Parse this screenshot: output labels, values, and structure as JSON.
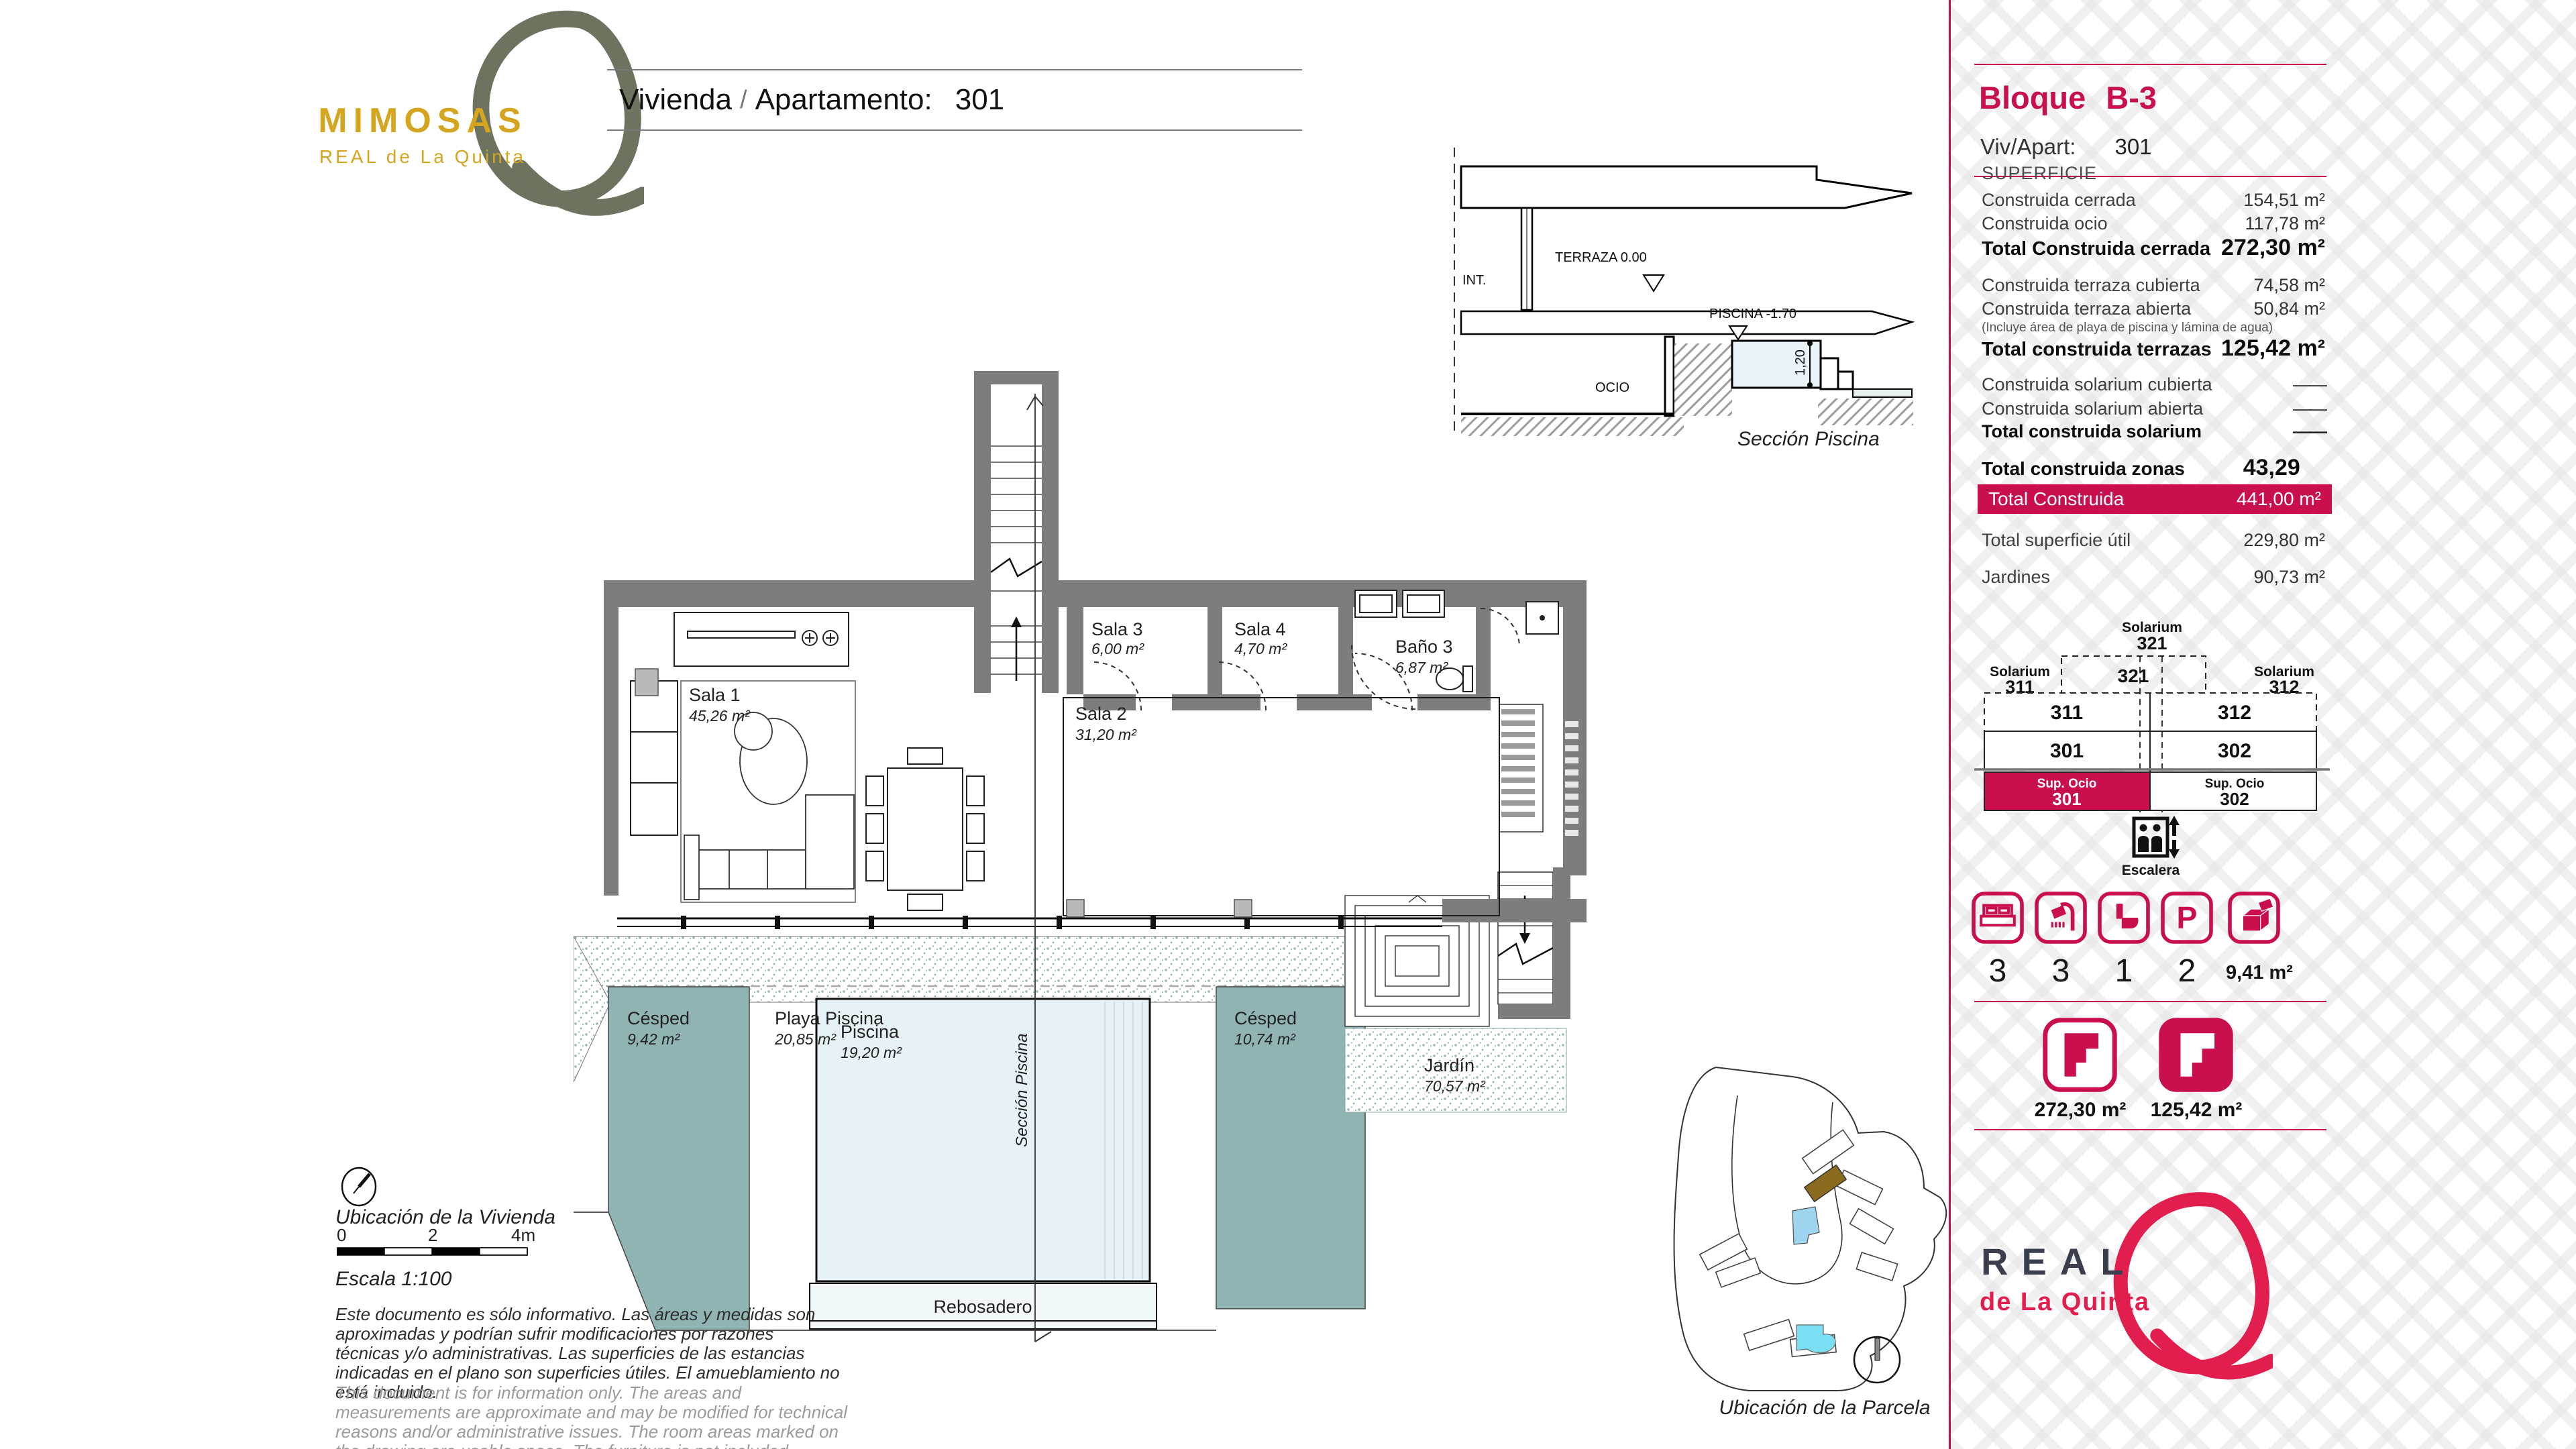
{
  "header": {
    "brand": {
      "name": "MIMOSAS",
      "sub": "REAL de La Quinta"
    },
    "title": {
      "label": "Vivienda",
      "sep": "/",
      "field": "Apartamento:",
      "value": "301"
    }
  },
  "inset": {
    "int": "INT.",
    "terraza": "TERRAZA 0.00",
    "piscina": "PISCINA -1.70",
    "ocio": "OCIO",
    "depth": "1,20",
    "caption": "Sección Piscina"
  },
  "plan": {
    "rooms": [
      {
        "name": "Sala 1",
        "area": "45,26 m²"
      },
      {
        "name": "Sala 2",
        "area": "31,20 m²"
      },
      {
        "name": "Sala 3",
        "area": "6,00 m²"
      },
      {
        "name": "Sala 4",
        "area": "4,70 m²"
      },
      {
        "name": "Baño 3",
        "area": "6,87 m²"
      },
      {
        "name": "Césped",
        "area": "9,42 m²"
      },
      {
        "name": "Playa Piscina",
        "area": "20,85 m²"
      },
      {
        "name": "Piscina",
        "area": "19,20 m²"
      },
      {
        "name": "Césped",
        "area": "10,74 m²"
      },
      {
        "name": "Jardín",
        "area": "70,57 m²"
      }
    ],
    "rebosadero": "Rebosadero",
    "section_line": "Sección Piscina"
  },
  "notes": {
    "location_caption": "Ubicación de la Vivienda",
    "scale_ticks": [
      "0",
      "2",
      "4m"
    ],
    "scale_label": "Escala 1:100",
    "disclaimer_es": "Este documento es sólo informativo. Las áreas y medidas son aproximadas y podrían sufrir modificaciones por razones técnicas y/o administrativas. Las superficies de las estancias indicadas en el plano son superficies útiles. El amueblamiento no está incluido.",
    "disclaimer_en": "This document is for information only. The areas and measurements are approximate and may be modified for technical reasons and/or administrative issues. The room areas marked on the drawing are usable space. The furniture is not included."
  },
  "siteplan": {
    "caption": "Ubicación de la Parcela"
  },
  "sidebar": {
    "bloque_label": "Bloque",
    "bloque_value": "B-3",
    "viv_label": "Viv/Apart:",
    "viv_value": "301",
    "superficie_title": "SUPERFICIE",
    "note": "(Incluye área de playa de piscina y lámina de agua)",
    "rows": [
      {
        "label": "Construida cerrada",
        "value": "154,51 m²"
      },
      {
        "label": "Construida ocio",
        "value": "117,78 m²"
      },
      {
        "label": "Total Construida cerrada",
        "value": "272,30 m²"
      },
      {
        "label": "Construida terraza cubierta",
        "value": "74,58 m²"
      },
      {
        "label": "Construida terraza abierta",
        "value": "50,84 m²"
      },
      {
        "label": "Total construida terrazas",
        "value": "125,42 m²"
      },
      {
        "label": "Construida solarium cubierta",
        "value": "——"
      },
      {
        "label": "Construida solarium abierta",
        "value": "——"
      },
      {
        "label": "Total construida solarium",
        "value": "——"
      },
      {
        "label": "Total construida zonas comunes",
        "value": "43,29 m²"
      },
      {
        "label": "Total Construida",
        "value": "441,00 m²"
      },
      {
        "label": "Total superficie útil",
        "value": "229,80 m²"
      },
      {
        "label": "Jardines",
        "value": "90,73 m²"
      }
    ],
    "diagram": {
      "solarium_top": "Solarium",
      "solarium_top_num": "321",
      "box_num": "321",
      "solarium_left": "Solarium",
      "solarium_left_num": "311",
      "solarium_right": "Solarium",
      "solarium_right_num": "312",
      "r1c1": "311",
      "r1c2": "312",
      "r2c1": "301",
      "r2c2": "302",
      "ocio_left_label": "Sup. Ocio",
      "ocio_left_num": "301",
      "ocio_right_label": "Sup. Ocio",
      "ocio_right_num": "302",
      "escalera": "Escalera"
    },
    "amenities": [
      {
        "icon": "bed-icon",
        "value": "3"
      },
      {
        "icon": "shower-icon",
        "value": "3"
      },
      {
        "icon": "toilet-icon",
        "value": "1"
      },
      {
        "icon": "parking-icon",
        "value": "2",
        "glyph": "P"
      },
      {
        "icon": "storage-icon",
        "value": "9,41 m²"
      }
    ],
    "area_badges": [
      {
        "value": "272,30 m²"
      },
      {
        "value": "125,42 m²"
      }
    ],
    "logo": {
      "line1": "REAL",
      "line2": "de La Quinta"
    }
  },
  "colors": {
    "accent": "#c9104c",
    "logo_red": "#e11e4d",
    "gold": "#d6a51f",
    "olive": "#6c7460",
    "navy": "#3b3f4d",
    "wall": "#7d7d7d",
    "grass": "#8fb4b1",
    "pool": "#e7f2f7"
  }
}
